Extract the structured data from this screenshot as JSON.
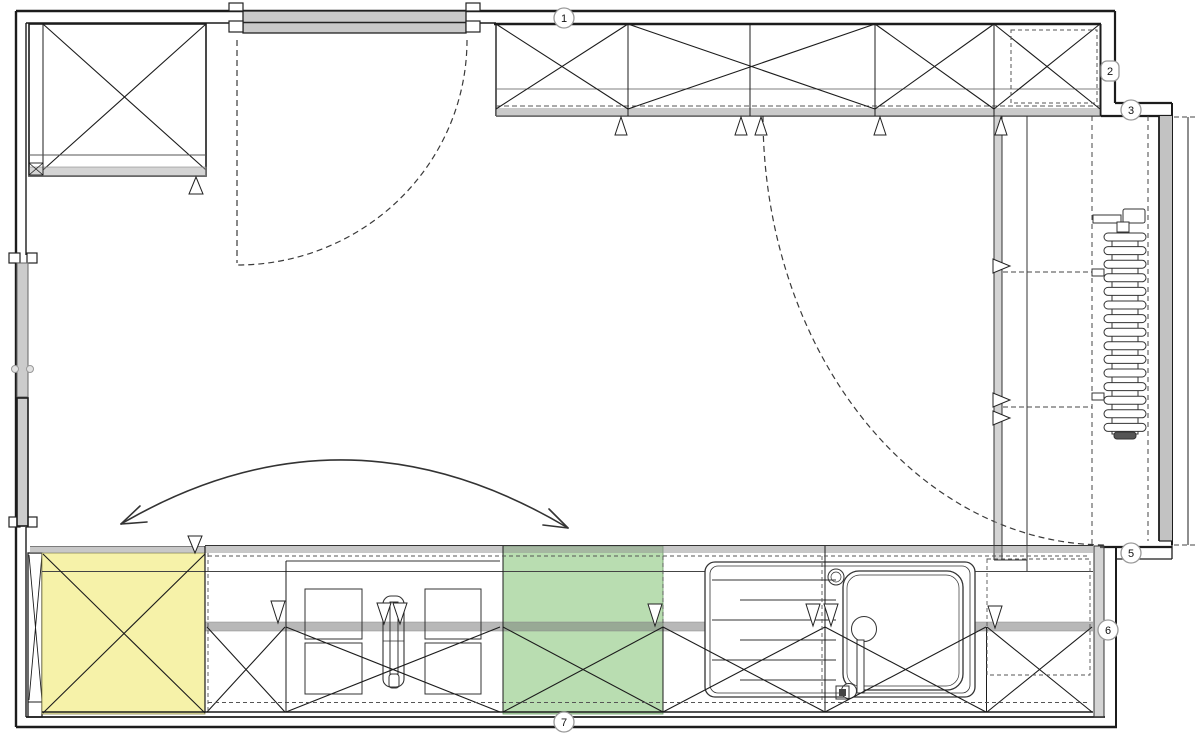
{
  "colors": {
    "line": "#1c1c1c",
    "door_gray": "#c9c9c9",
    "wall_gray": "#c2c2c2",
    "pane_gray": "#cccccc",
    "highlight_yellow": "#f6f2a9",
    "highlight_green": "#b9ddb1"
  },
  "callouts": [
    {
      "label": "1",
      "x": 564,
      "y": 18,
      "shape": "circle"
    },
    {
      "label": "2",
      "x": 1110,
      "y": 71,
      "shape": "square"
    },
    {
      "label": "3",
      "x": 1131,
      "y": 110,
      "shape": "circle"
    },
    {
      "label": "5",
      "x": 1131,
      "y": 553,
      "shape": "circle"
    },
    {
      "label": "6",
      "x": 1108,
      "y": 630,
      "shape": "circle"
    },
    {
      "label": "7",
      "x": 564,
      "y": 722,
      "shape": "circle"
    }
  ]
}
